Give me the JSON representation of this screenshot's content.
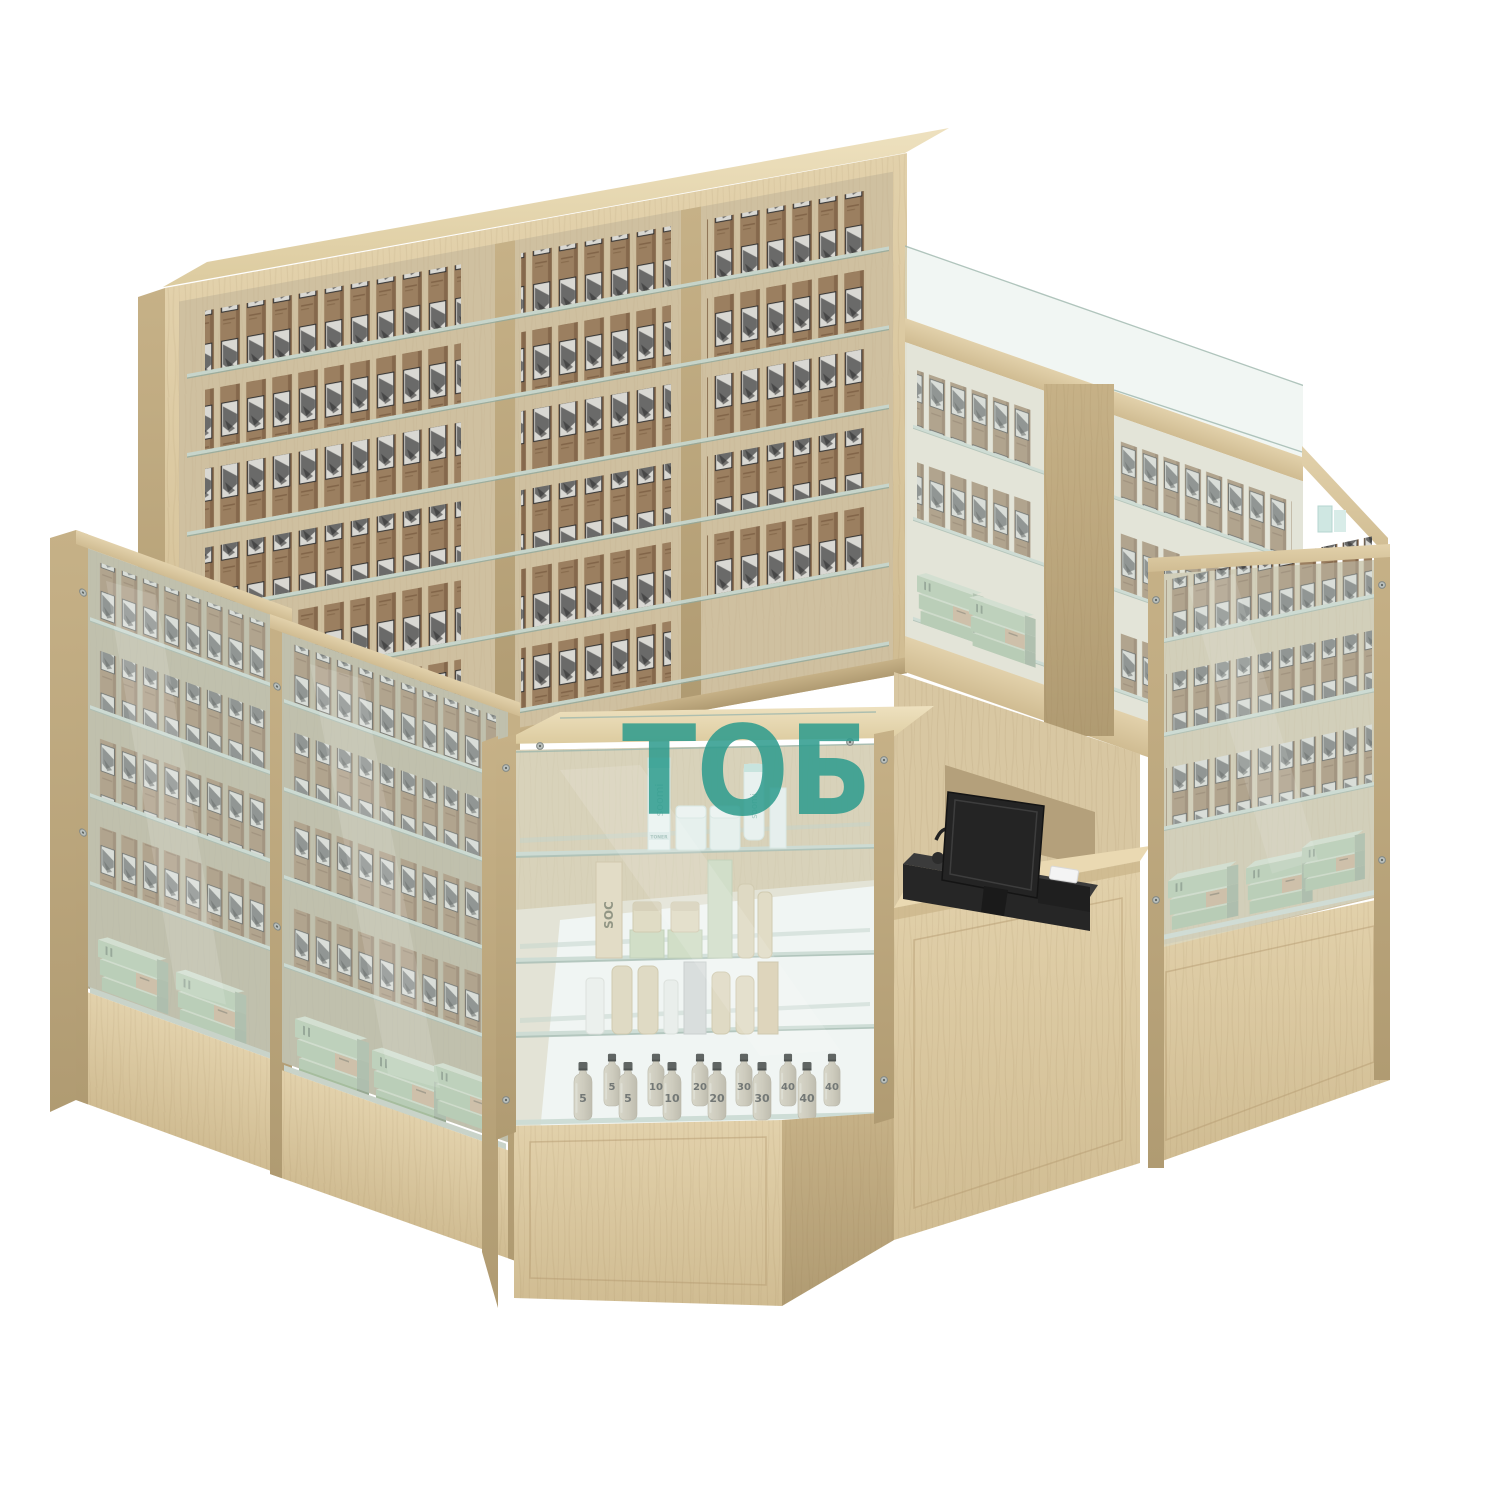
{
  "scene": {
    "type": "3d-product-render",
    "subject": "corner retail cosmetics kiosk: wooden shelving walls with hair-color boxes, glass display cases, corner showcase, cashier counter with POS terminal",
    "background": "#FFFFFF"
  },
  "watermark": {
    "text": "ТОБ",
    "color": "#2E9C8E"
  },
  "brands": {
    "skincare": "soomi",
    "skincare_small_label": "TONER",
    "cosmetics": "SOC"
  },
  "bottles": {
    "back": [
      "5",
      "10",
      "20",
      "30",
      "40",
      "40"
    ],
    "front": [
      "5",
      "5",
      "10",
      "20",
      "30",
      "40"
    ]
  },
  "fixtures": {
    "back_wall": {
      "bays": 3,
      "box_rows_per_bay": 6
    },
    "back_right_wall_rows": 3,
    "left_glass_cases": 2,
    "right_glass_case_rows": 3,
    "corner_showcase_shelves": 4,
    "pos": {
      "monitor": "black display, rear view",
      "printer": "receipt printer with white paper roll"
    }
  },
  "palette": {
    "wood": "#DCC9A3",
    "wood_dark": "#C3AE86",
    "wood_side": "#B5A077",
    "wood_top": "#E9DCBA",
    "glass": "#D8E7E0",
    "glass_edge": "#9DB7AD",
    "box_kraft": "#9B7F60",
    "box_photo": "#D9D8D3",
    "green_box": "#AAC0A2",
    "beige_accent": "#C8AB8B",
    "bottle": "#C9BFAE",
    "cap": "#1D1D1D",
    "pos_black": "#262626"
  }
}
